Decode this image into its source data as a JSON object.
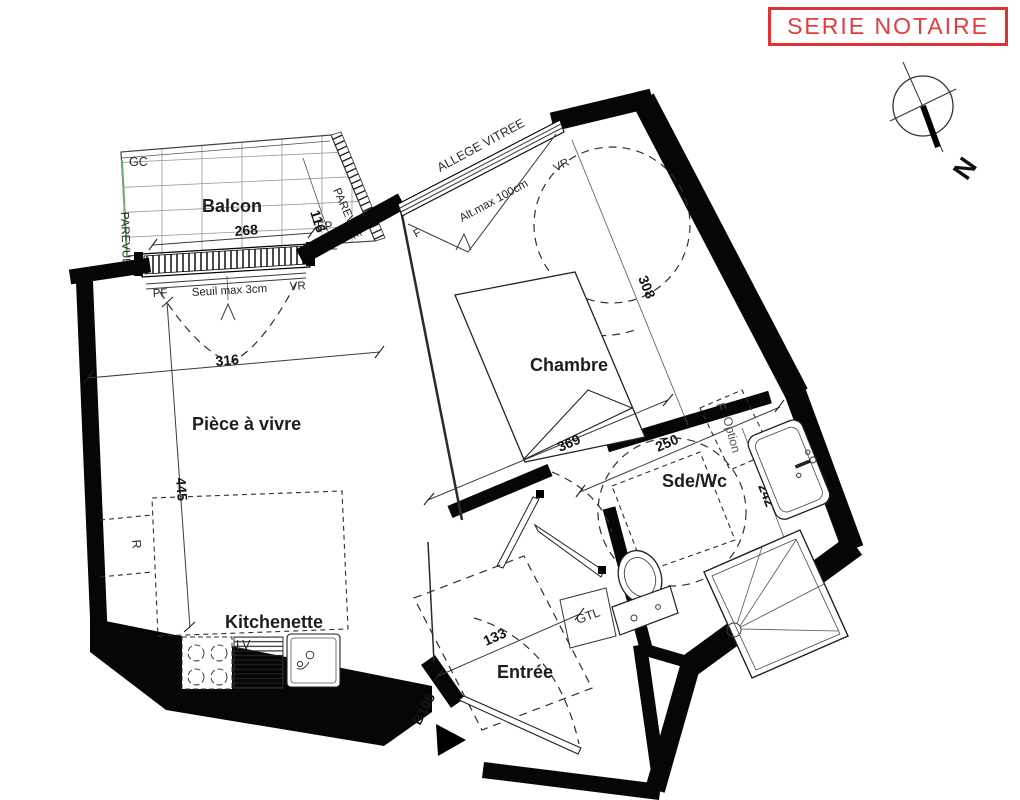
{
  "stamp": {
    "text": "SERIE NOTAIRE"
  },
  "compass": {
    "north": "N"
  },
  "balcony": {
    "label": "Balcon",
    "width_cm": "268",
    "depth_cm": "116",
    "gc": "GC",
    "parevue_left": "PAREVUE",
    "parevue_edge": "PAREVUE",
    "ep": "EP",
    "pf": "PF",
    "seuil_note": "Seuil max 3cm",
    "vr": "VR"
  },
  "living": {
    "label": "Pièce à vivre",
    "width_cm": "316",
    "depth_cm": "445",
    "r_note": "R"
  },
  "kitchen": {
    "label": "Kitchenette",
    "lv": "LV"
  },
  "bedroom": {
    "label": "Chambre",
    "width_cm": "369",
    "length_cm": "308",
    "window_note": "ALLEGE VITREE",
    "window_f": "F",
    "window_alt": "Alt.max 100cm",
    "window_vr": "VR"
  },
  "bathroom": {
    "label": "Sde/Wc",
    "width_cm": "250",
    "depth_cm": "242",
    "option_f": "F",
    "option": "Option",
    "gtl": "GTL"
  },
  "entry": {
    "label": "Entrée",
    "width_cm": "133",
    "unit_number": "B105"
  }
}
